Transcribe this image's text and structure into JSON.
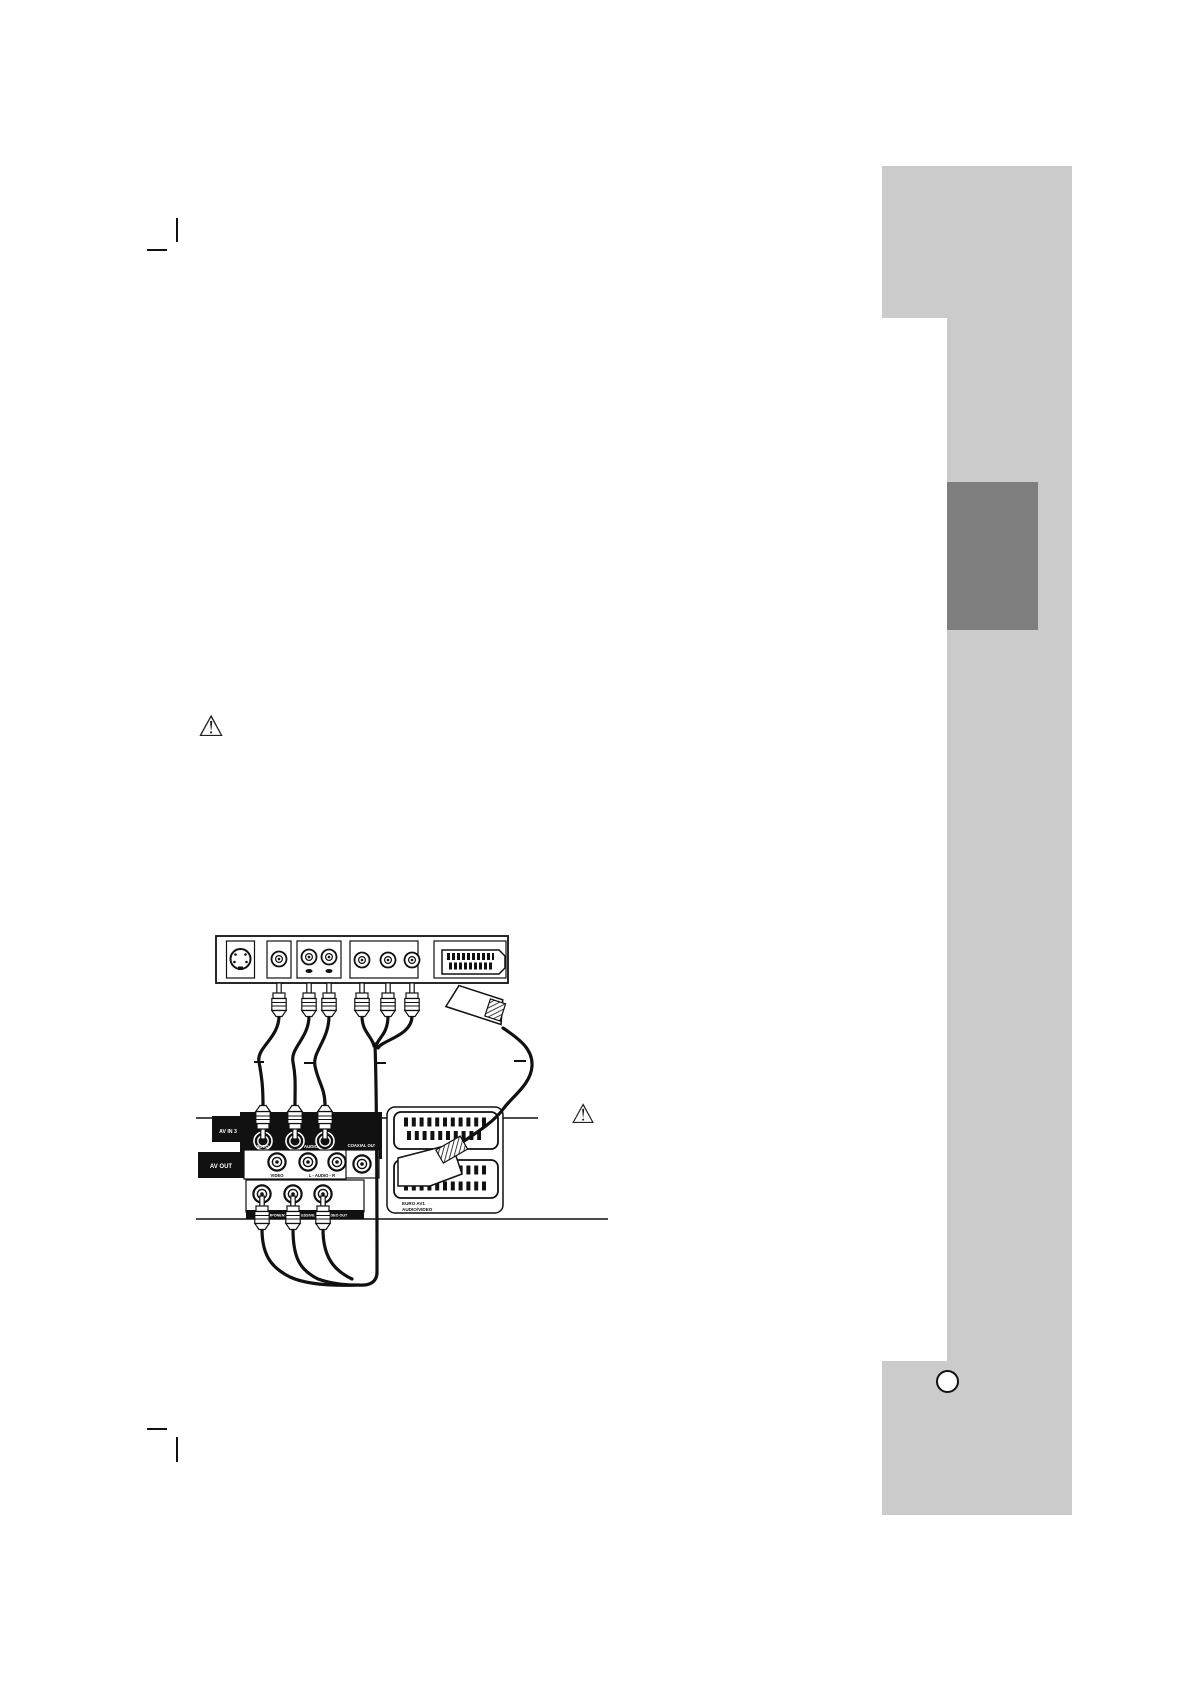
{
  "page": {
    "background": "#ffffff",
    "ink": "#111111"
  },
  "sidebar": {
    "light_gray": "#cbcbcb",
    "dark_gray": "#7e7e7e"
  },
  "icons": {
    "warning": "⚠"
  },
  "diagram": {
    "labels": {
      "av_in": "AV IN 3",
      "av_in_video": "VIDEO",
      "av_in_audio": "AUDIO",
      "coaxial": "COAXIAL OUT",
      "av_out": "AV OUT",
      "av_out_video": "VIDEO",
      "av_out_audio": "L - AUDIO - R",
      "component": "COMPONENT/PROGRESSIVE SCAN VIDEO OUT",
      "scart_line1": "EURO AV1",
      "scart_line2": "AUDIO/VIDEO"
    }
  }
}
